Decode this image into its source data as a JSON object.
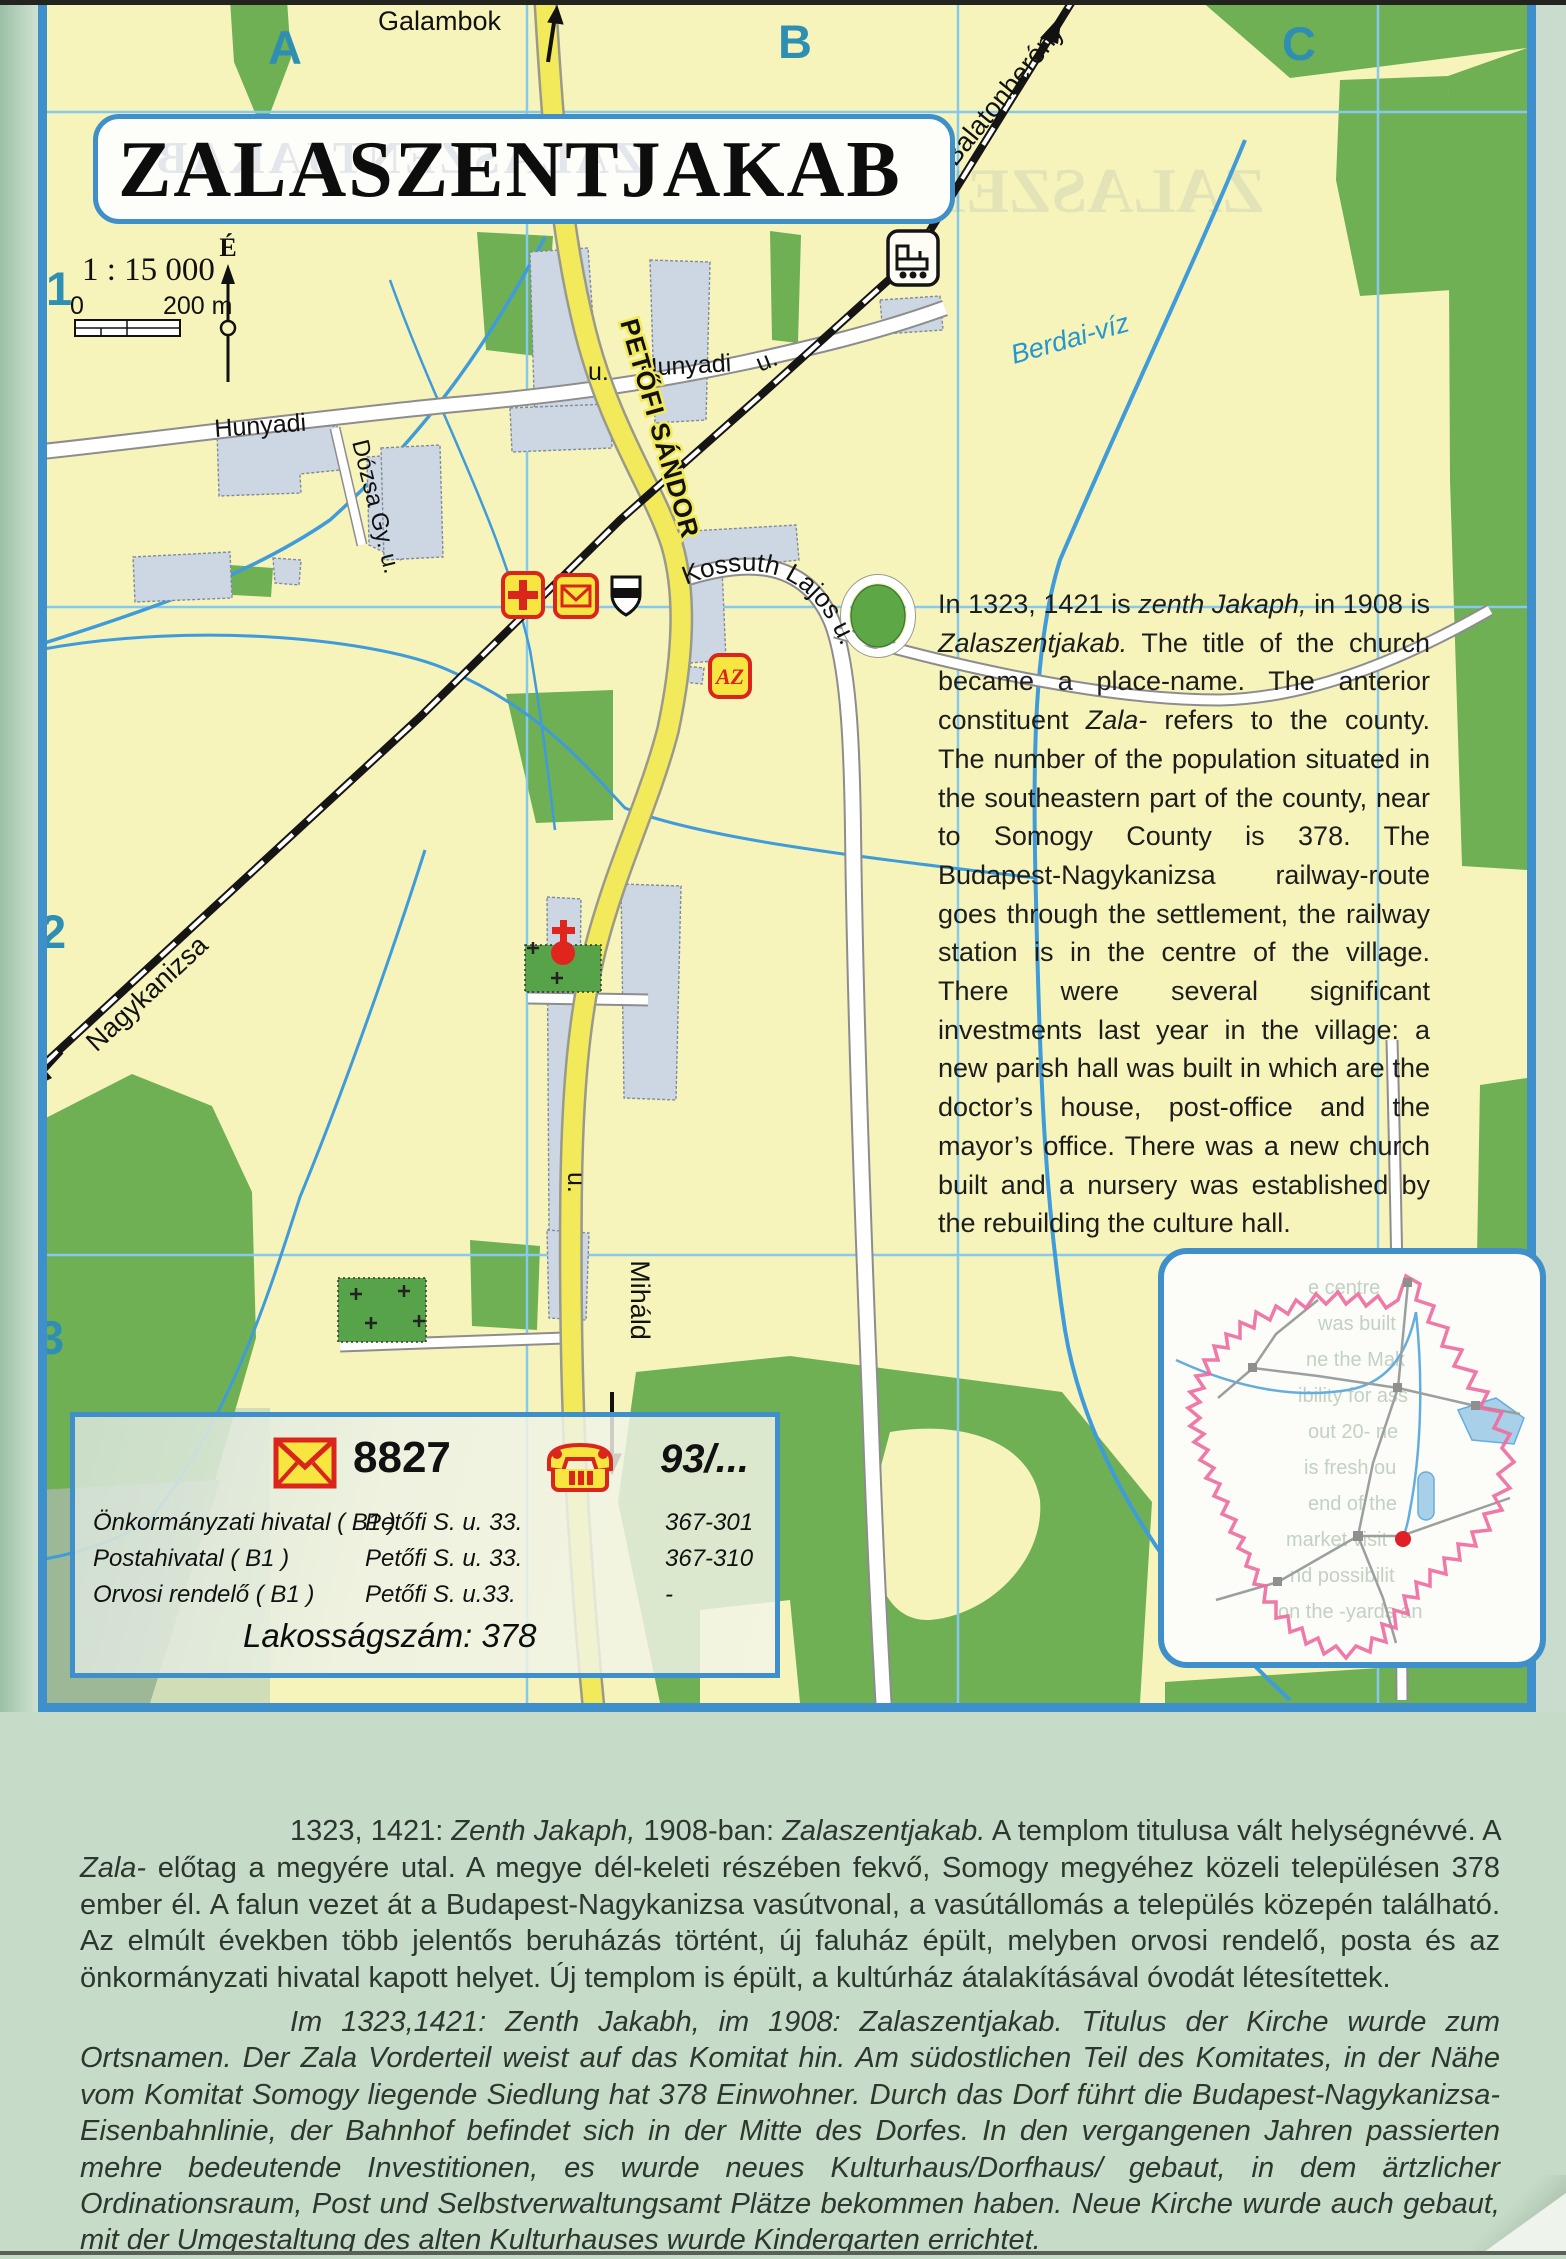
{
  "title": "ZALASZENTJAKAB",
  "map": {
    "scale_text": "1 : 15 000",
    "scale_zero": "0",
    "scale_max": "200 m",
    "north_label": "É",
    "grid_columns": [
      "A",
      "B",
      "C"
    ],
    "grid_rows": [
      "1",
      "2",
      "3"
    ],
    "directions": {
      "galambok": "Galambok",
      "balatonbereny": "Balatonberény",
      "nagykanizsa": "Nagykanizsa",
      "mihald": "Miháld"
    },
    "streets": {
      "petofi": "PETŐFI SÁNDOR",
      "kossuth": "Kossuth Lajos u.",
      "hunyadi_left": "Hunyadi",
      "hunyadi_mid": "Hunyadi",
      "u_mid": "u.",
      "u_right": "u.",
      "u_bottom": "u.",
      "dozsa": "Dózsa Gy. u."
    },
    "water_labels": {
      "berdai": "Berdai-víz"
    },
    "icon_labels": {
      "az_store": "AZ"
    }
  },
  "info_box": {
    "postal_code": "8827",
    "phone_prefix": "93/...",
    "rows": [
      {
        "name": "Önkormányzati hivatal ( B1 )",
        "address": "Petőfi S. u. 33.",
        "phone": "367-301"
      },
      {
        "name": "Postahivatal ( B1 )",
        "address": "Petőfi S. u. 33.",
        "phone": "367-310"
      },
      {
        "name": "Orvosi rendelő ( B1 )",
        "address": "Petőfi S. u.33.",
        "phone": "-"
      }
    ],
    "population_label": "Lakosságszám: 378"
  },
  "texts": {
    "en": [
      {
        "t": "In 1323, 1421 is ",
        "i": false
      },
      {
        "t": "zenth Jakaph,",
        "i": true
      },
      {
        "t": " in 1908 is ",
        "i": false
      },
      {
        "t": "Zalaszentjakab.",
        "i": true
      },
      {
        "t": " The title of the church became a place-name. The anterior constituent ",
        "i": false
      },
      {
        "t": "Zala-",
        "i": true
      },
      {
        "t": " refers to the county. The number of the population situated in the southeastern part of the county, near to Somogy County is 378. The Budapest-Nagykanizsa railway-route goes through the settlement, the railway station is in the centre of the village. There were several significant investments last year in the village: a new parish hall was built in which are the doctor’s house, post-office and the mayor’s office. There was a new church built and a nursery was established by the rebuilding the culture hall.",
        "i": false
      }
    ],
    "hu": [
      {
        "t": "1323, 1421: ",
        "i": false
      },
      {
        "t": "Zenth Jakaph,",
        "i": true
      },
      {
        "t": " 1908-ban: ",
        "i": false
      },
      {
        "t": "Zalaszentjakab.",
        "i": true
      },
      {
        "t": " A templom titulusa vált helységnévvé. A ",
        "i": false
      },
      {
        "t": "Zala-",
        "i": true
      },
      {
        "t": " előtag a megyére utal. A megye dél-keleti részében fekvő, Somogy megyéhez közeli településen 378 ember él. A falun vezet át a Budapest-Nagykanizsa vasútvonal, a vasútállomás a település közepén található. Az elmúlt években több jelentős beruházás történt, új faluház épült, melyben orvosi rendelő, posta és az önkormányzati hivatal kapott helyet. Új templom is épült, a kultúrház átalakításával óvodát létesítettek.",
        "i": false
      }
    ],
    "de": [
      {
        "t": "Im 1323,1421: Zenth Jakabh, im 1908: Zalaszentjakab. Titulus der Kirche wurde zum Ortsnamen. Der Zala Vorderteil weist auf das Komitat hin. Am südostlichen Teil des Komitates, in der Nähe vom Komitat Somogy liegende Siedlung hat 378 Einwohner. Durch das Dorf führt die Budapest-Nagykanizsa-Eisenbahnlinie, der Bahnhof befindet sich in der Mitte des Dorfes. In den vergangenen Jahren passierten mehre bedeutende Investitionen, es wurde neues Kulturhaus/Dorfhaus/ gebaut, in dem ärtzlicher Ordinationsraum, Post und Selbstverwaltungsamt Plätze bekommen haben. Neue Kirche wurde auch gebaut, mit der Umgestaltung des alten Kulturhauses wurde Kindergarten errichtet.",
        "i": false
      }
    ]
  },
  "ghost": {
    "title": "ZALASZENTJAKAB",
    "map_watermark": "ZALASZENT",
    "inset_lines": [
      "e centre",
      "was built",
      "ne the Mak",
      "ibility for ass",
      "out 20- ne",
      "is fresh ou",
      "end of the",
      "market visit",
      "nd possibilit",
      "on the -yards an"
    ]
  },
  "colors": {
    "frame_blue": "#3f8fcb",
    "map_yellow": "#f6f4bb",
    "green": "#6fb054",
    "road_yellow": "#f2ea5a",
    "water_blue": "#3f9bd9",
    "grid_teal": "#2f8fb3",
    "icon_red": "#da251d",
    "icon_yellow": "#f7e63f",
    "county_pink": "#ee6a9e"
  }
}
